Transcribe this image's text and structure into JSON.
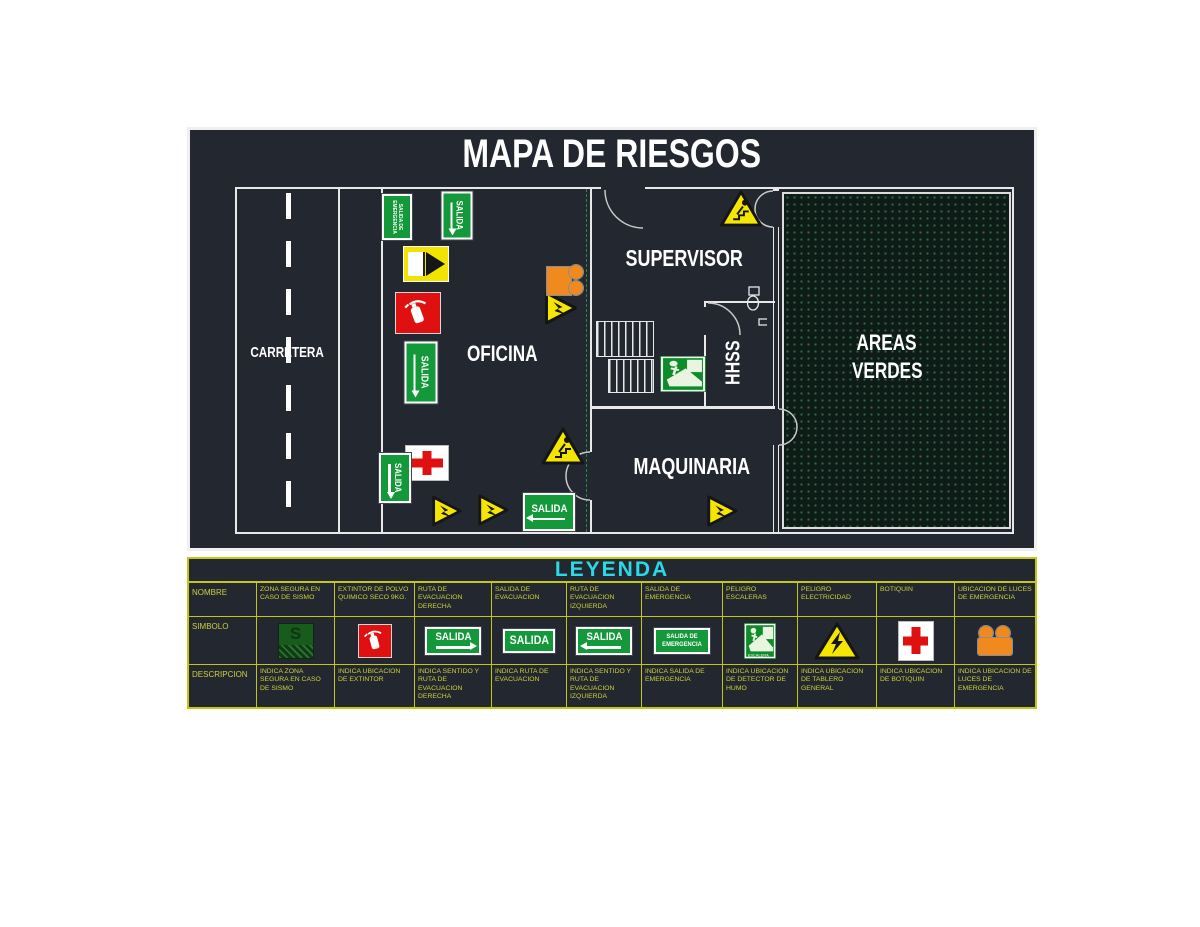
{
  "title": "MAPA DE RIESGOS",
  "plan": {
    "labels": {
      "carretera": "CARRETERA",
      "oficina": "OFICINA",
      "supervisor": "SUPERVISOR",
      "hhss": "HHSS",
      "maquinaria": "MAQUINARIA",
      "areas_verdes_line1": "AREAS",
      "areas_verdes_line2": "VERDES"
    },
    "sign_text": {
      "salida": "SALIDA",
      "salida_de_emergencia": "SALIDA DE EMERGENCIA"
    }
  },
  "legend": {
    "title": "LEYENDA",
    "row_labels": {
      "name": "NOMBRE",
      "symbol": "SIMBOLO",
      "description": "DESCRIPCION"
    },
    "columns": [
      {
        "name": "ZONA SEGURA EN CASO DE SISMO",
        "symbol": "zona-segura-sign",
        "symbol_text": "S",
        "description": "INDICA ZONA SEGURA EN CASO DE SISMO"
      },
      {
        "name": "EXTINTOR DE POLVO QUIMICO SECO 9KG.",
        "symbol": "extintor-sign",
        "description": "INDICA UBICACION DE EXTINTOR"
      },
      {
        "name": "RUTA DE EVACUACION DERECHA",
        "symbol": "salida-flecha-derecha-sign",
        "symbol_text": "SALIDA",
        "description": "INDICA SENTIDO Y RUTA DE EVACUACION DERECHA"
      },
      {
        "name": "SALIDA DE EVACUACION",
        "symbol": "salida-sign",
        "symbol_text": "SALIDA",
        "description": "INDICA RUTA DE EVACUACION"
      },
      {
        "name": "RUTA DE EVACUACION IZQUIERDA",
        "symbol": "salida-flecha-izquierda-sign",
        "symbol_text": "SALIDA",
        "description": "INDICA SENTIDO Y RUTA DE EVACUACION IZQUIERDA"
      },
      {
        "name": "SALIDA DE EMERGENCIA",
        "symbol": "salida-emergencia-sign",
        "symbol_text": "SALIDA DE EMERGENCIA",
        "description": "INDICA SALIDA DE EMERGENCIA"
      },
      {
        "name": "PELIGRO ESCALERAS",
        "symbol": "escalera-sign",
        "symbol_text": "ESCALERA",
        "description": "INDICA UBICACION DE DETECTOR DE HUMO"
      },
      {
        "name": "PELIGRO ELECTRICIDAD",
        "symbol": "peligro-electricidad-sign",
        "description": "INDICA UBICACION DE TABLERO GENERAL"
      },
      {
        "name": "BOTIQUIN",
        "symbol": "botiquin-sign",
        "description": "INDICA UBICACION DE BOTIQUIN"
      },
      {
        "name": "UBICACION DE LUCES DE EMERGENCIA",
        "symbol": "luces-emergencia-sign",
        "description": "INDICA UBICACION DE LUCES DE EMERGENCIA"
      }
    ]
  },
  "colors": {
    "background": "#232830",
    "wall": "#e8e8e8",
    "cad_yellow": "#cdd03a",
    "legend_cyan": "#2bd8e6",
    "sign_green": "#13983a",
    "alert_red": "#e01010",
    "warning_yellow": "#f4e600",
    "safety_orange": "#f08a1e",
    "areas_verdes_dot": "#2c6b4c"
  }
}
